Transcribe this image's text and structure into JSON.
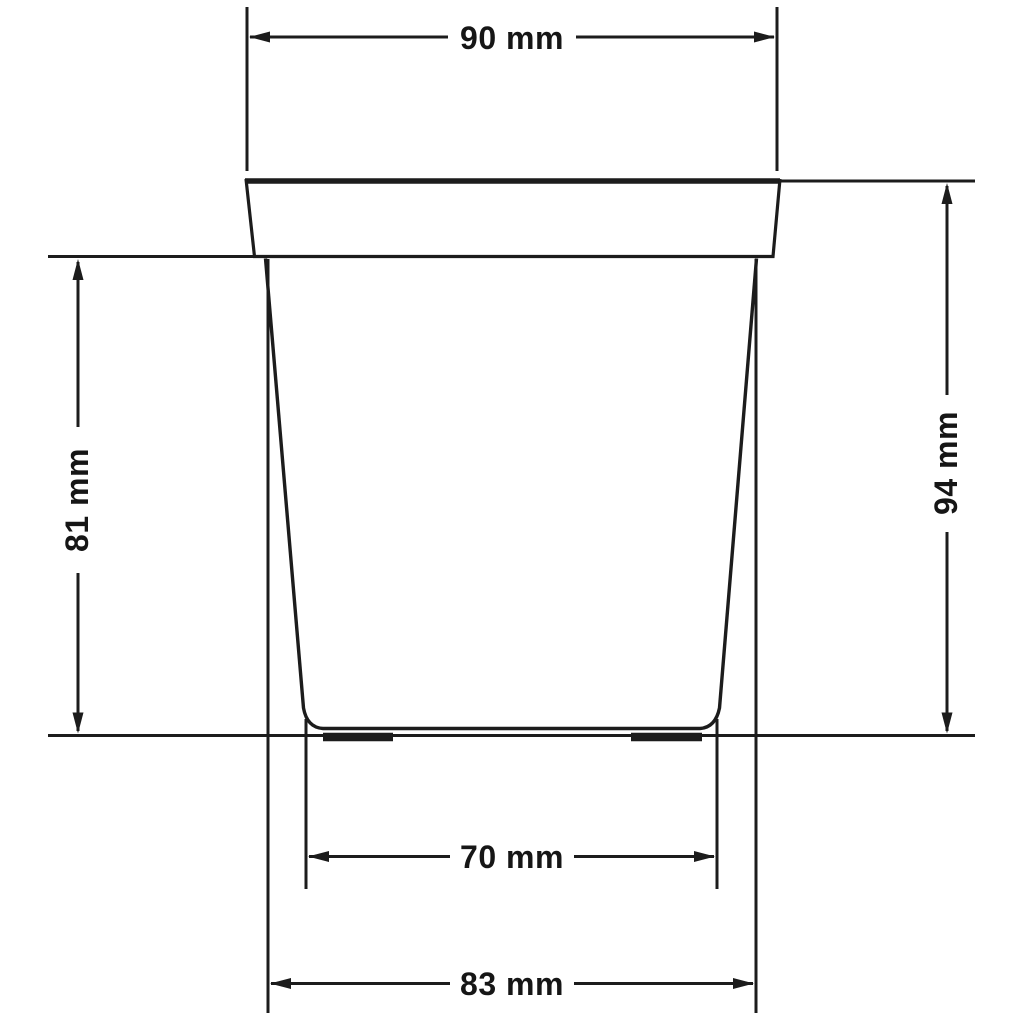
{
  "drawing": {
    "type": "technical-dimension-drawing",
    "subject": "plant pot side view with dimension callouts",
    "background_color": "#ffffff",
    "line_color": "#1a1a1a",
    "text_color": "#131313",
    "dimensions": {
      "top_width": {
        "label": "90 mm",
        "value": 90,
        "unit": "mm",
        "position": "top"
      },
      "body_height": {
        "label": "81 mm",
        "value": 81,
        "unit": "mm",
        "position": "left"
      },
      "total_height": {
        "label": "94 mm",
        "value": 94,
        "unit": "mm",
        "position": "right"
      },
      "base_width": {
        "label": "70 mm",
        "value": 70,
        "unit": "mm",
        "position": "bottom-upper"
      },
      "lower_width": {
        "label": "83 mm",
        "value": 83,
        "unit": "mm",
        "position": "bottom-lower"
      }
    }
  }
}
